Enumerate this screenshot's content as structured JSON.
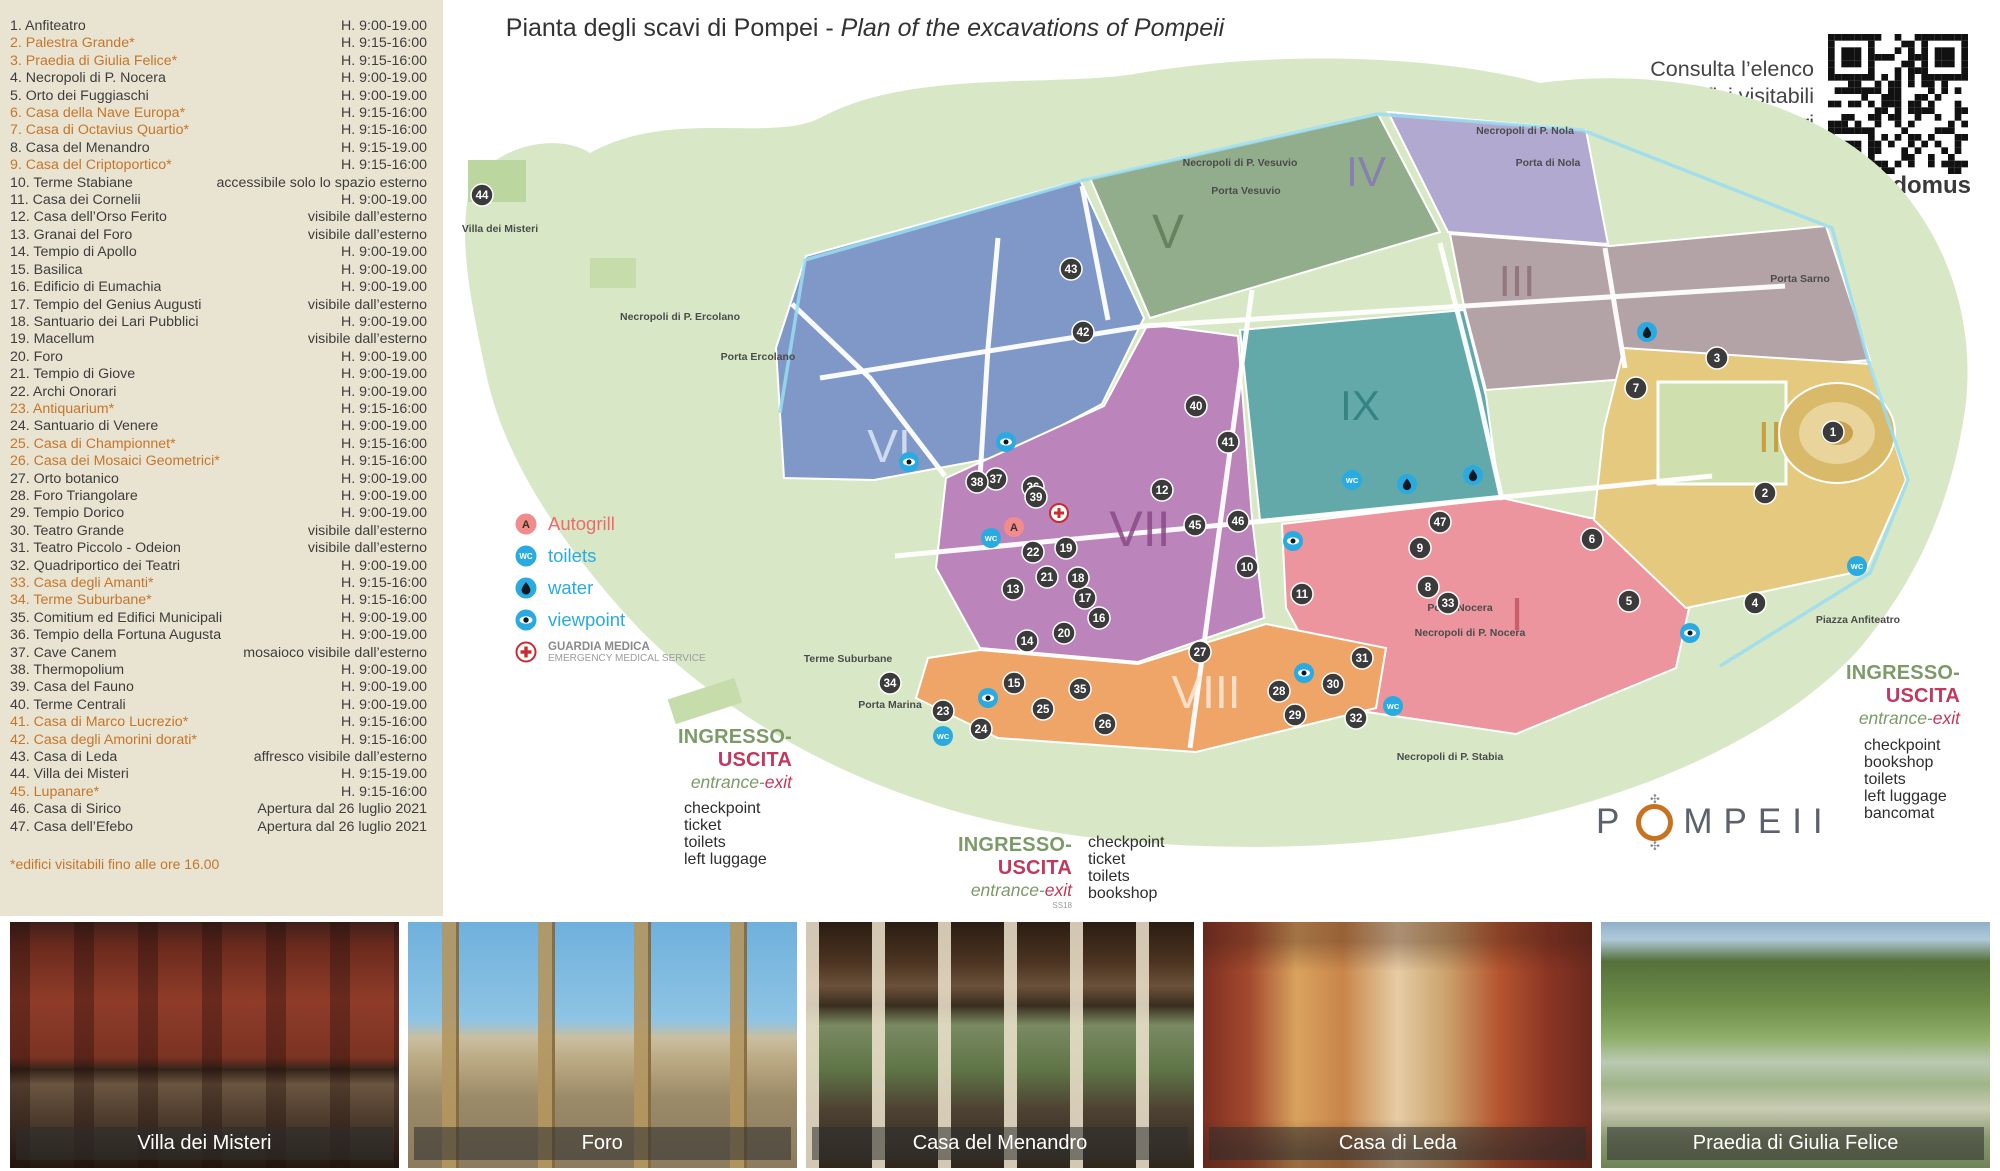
{
  "title": {
    "it": "Pianta degli scavi di Pompei",
    "sep": " - ",
    "en": "Plan of the excavations of Pompeii"
  },
  "info": {
    "lines": [
      "Consulta l’elenco",
      "degli edifici visitabili",
      "aggiornato e gli orari",
      "di apertura"
    ],
    "url": "pompeiisites.org/infodomus",
    "qr": "qr-code"
  },
  "sidebar": {
    "items": [
      {
        "label": "1. Anfiteatro",
        "hours": "H. 9:00-19.00",
        "star": false
      },
      {
        "label": "2. Palestra Grande*",
        "hours": "H. 9:15-16:00",
        "star": true
      },
      {
        "label": "3. Praedia di Giulia Felice*",
        "hours": "H. 9:15-16:00",
        "star": true
      },
      {
        "label": "4. Necropoli di P. Nocera",
        "hours": "H. 9:00-19.00",
        "star": false
      },
      {
        "label": "5. Orto dei Fuggiaschi",
        "hours": "H. 9:00-19.00",
        "star": false
      },
      {
        "label": "6. Casa della Nave Europa*",
        "hours": "H. 9:15-16:00",
        "star": true
      },
      {
        "label": "7. Casa di Octavius Quartio*",
        "hours": "H. 9:15-16:00",
        "star": true
      },
      {
        "label": "8. Casa del Menandro",
        "hours": "H. 9:15-19.00",
        "star": false
      },
      {
        "label": "9. Casa del Criptoportico*",
        "hours": "H. 9:15-16:00",
        "star": true
      },
      {
        "label": "10. Terme Stabiane",
        "hours": "accessibile solo lo spazio esterno",
        "star": false
      },
      {
        "label": "11. Casa dei Cornelii",
        "hours": "H. 9:00-19.00",
        "star": false
      },
      {
        "label": "12. Casa dell’Orso Ferito",
        "hours": "visibile dall’esterno",
        "star": false
      },
      {
        "label": "13. Granai del Foro",
        "hours": "visibile dall’esterno",
        "star": false
      },
      {
        "label": "14. Tempio di Apollo",
        "hours": "H. 9:00-19.00",
        "star": false
      },
      {
        "label": "15. Basilica",
        "hours": "H. 9:00-19.00",
        "star": false
      },
      {
        "label": "16. Edificio di Eumachia",
        "hours": "H. 9:00-19.00",
        "star": false
      },
      {
        "label": "17. Tempio del Genius Augusti",
        "hours": "visibile dall’esterno",
        "star": false
      },
      {
        "label": "18. Santuario dei Lari Pubblici",
        "hours": "H. 9:00-19.00",
        "star": false
      },
      {
        "label": "19. Macellum",
        "hours": "visibile dall’esterno",
        "star": false
      },
      {
        "label": "20. Foro",
        "hours": "H. 9:00-19.00",
        "star": false
      },
      {
        "label": "21. Tempio di Giove",
        "hours": "H. 9:00-19.00",
        "star": false
      },
      {
        "label": "22. Archi Onorari",
        "hours": "H. 9:00-19.00",
        "star": false
      },
      {
        "label": "23. Antiquarium*",
        "hours": "H. 9:15-16:00",
        "star": true
      },
      {
        "label": "24. Santuario di Venere",
        "hours": "H. 9:00-19.00",
        "star": false
      },
      {
        "label": "25. Casa di Championnet*",
        "hours": "H. 9:15-16:00",
        "star": true
      },
      {
        "label": "26. Casa dei Mosaici Geometrici*",
        "hours": "H. 9:15-16:00",
        "star": true
      },
      {
        "label": "27. Orto botanico",
        "hours": "H. 9:00-19.00",
        "star": false
      },
      {
        "label": "28. Foro Triangolare",
        "hours": "H. 9:00-19.00",
        "star": false
      },
      {
        "label": "29. Tempio Dorico",
        "hours": "H. 9:00-19.00",
        "star": false
      },
      {
        "label": "30. Teatro Grande",
        "hours": "visibile dall’esterno",
        "star": false
      },
      {
        "label": "31. Teatro Piccolo - Odeion",
        "hours": "visibile dall’esterno",
        "star": false
      },
      {
        "label": "32. Quadriportico dei Teatri",
        "hours": "H. 9:00-19.00",
        "star": false
      },
      {
        "label": "33. Casa degli Amanti*",
        "hours": "H. 9:15-16:00",
        "star": true
      },
      {
        "label": "34. Terme Suburbane*",
        "hours": "H. 9:15-16:00",
        "star": true
      },
      {
        "label": "35. Comitium ed Edifici Municipali",
        "hours": "H. 9:00-19.00",
        "star": false
      },
      {
        "label": "36. Tempio della Fortuna Augusta",
        "hours": "H. 9:00-19.00",
        "star": false
      },
      {
        "label": "37. Cave Canem",
        "hours": "mosaioco visibile dall’esterno",
        "star": false
      },
      {
        "label": "38. Thermopolium",
        "hours": "H. 9:00-19.00",
        "star": false
      },
      {
        "label": "39. Casa del Fauno",
        "hours": "H. 9:00-19.00",
        "star": false
      },
      {
        "label": "40. Terme Centrali",
        "hours": "H. 9:00-19.00",
        "star": false
      },
      {
        "label": "41. Casa di Marco Lucrezio*",
        "hours": "H. 9:15-16:00",
        "star": true
      },
      {
        "label": "42. Casa degli Amorini dorati*",
        "hours": "H. 9:15-16:00",
        "star": true
      },
      {
        "label": "43. Casa di Leda",
        "hours": "affresco visibile dall’esterno",
        "star": false
      },
      {
        "label": "44. Villa dei Misteri",
        "hours": "H. 9:15-19.00",
        "star": false
      },
      {
        "label": "45. Lupanare*",
        "hours": "H. 9:15-16:00",
        "star": true
      },
      {
        "label": "46. Casa di Sirico",
        "hours": "Apertura dal 26 luglio 2021",
        "star": false
      },
      {
        "label": "47. Casa dell’Efebo",
        "hours": "Apertura dal 26 luglio 2021",
        "star": false
      }
    ],
    "footnote": "*edifici visitabili fino alle ore 16.00"
  },
  "legend": {
    "items": [
      {
        "type": "autogrill",
        "label": "Autogrill"
      },
      {
        "type": "wc",
        "label": "toilets"
      },
      {
        "type": "water",
        "label": "water"
      },
      {
        "type": "viewpoint",
        "label": "viewpoint"
      },
      {
        "type": "medic",
        "label": "GUARDIA MEDICA",
        "sub": "EMERGENCY MEDICAL SERVICE"
      }
    ]
  },
  "entrances": [
    {
      "name": "porta-marina",
      "ingresso": "INGRESSO-",
      "uscita": "USCITA",
      "entrance": "entrance-",
      "exit": "exit",
      "services": [
        "checkpoint",
        "ticket",
        "toilets",
        "left luggage"
      ]
    },
    {
      "name": "piazza-esedra",
      "ingresso": "INGRESSO-",
      "uscita": "USCITA",
      "entrance": "entrance-",
      "exit": "exit",
      "road_label": "SS18",
      "services": [
        "checkpoint",
        "ticket",
        "toilets",
        "bookshop"
      ]
    },
    {
      "name": "piazza-anfiteatro",
      "ingresso": "INGRESSO-",
      "uscita": "USCITA",
      "entrance": "entrance-",
      "exit": "exit",
      "services": [
        "checkpoint",
        "bookshop",
        "toilets",
        "left luggage",
        "bancomat"
      ]
    }
  ],
  "map": {
    "park_color": "#d8e8c6",
    "regions": [
      {
        "numeral": "VI",
        "fill": "#7f98c8",
        "label": "#dde6f6",
        "lx": 449,
        "ly": 414,
        "size": 46
      },
      {
        "numeral": "V",
        "fill": "#92ad8b",
        "label": "#5c7d56",
        "lx": 728,
        "ly": 200,
        "size": 48
      },
      {
        "numeral": "IV",
        "fill": "#b2a9d1",
        "label": "#8678b5",
        "lx": 926,
        "ly": 138,
        "size": 42
      },
      {
        "numeral": "III",
        "fill": "#b4a3a6",
        "label": "#8d7177",
        "lx": 1077,
        "ly": 248,
        "size": 44
      },
      {
        "numeral": "IX",
        "fill": "#63a9a9",
        "label": "#2f7d7d",
        "lx": 920,
        "ly": 372,
        "size": 42
      },
      {
        "numeral": "VII",
        "fill": "#bb84ba",
        "label": "#8a4a88",
        "lx": 700,
        "ly": 498,
        "size": 50
      },
      {
        "numeral": "I",
        "fill": "#ec959e",
        "label": "#c35663",
        "lx": 1077,
        "ly": 582,
        "size": 46
      },
      {
        "numeral": "II",
        "fill": "#e5c97e",
        "label": "#c8962f",
        "lx": 1330,
        "ly": 404,
        "size": 44
      },
      {
        "numeral": "VIII",
        "fill": "#efa468",
        "label": "#fbead8",
        "lx": 766,
        "ly": 660,
        "size": 46
      }
    ],
    "markers": [
      {
        "n": 1,
        "x": 1393,
        "y": 384
      },
      {
        "n": 2,
        "x": 1325,
        "y": 445
      },
      {
        "n": 3,
        "x": 1277,
        "y": 310
      },
      {
        "n": 4,
        "x": 1315,
        "y": 555
      },
      {
        "n": 5,
        "x": 1189,
        "y": 553
      },
      {
        "n": 6,
        "x": 1152,
        "y": 491
      },
      {
        "n": 7,
        "x": 1196,
        "y": 340
      },
      {
        "n": 8,
        "x": 988,
        "y": 539
      },
      {
        "n": 9,
        "x": 980,
        "y": 500
      },
      {
        "n": 10,
        "x": 807,
        "y": 519
      },
      {
        "n": 11,
        "x": 862,
        "y": 546
      },
      {
        "n": 12,
        "x": 722,
        "y": 442
      },
      {
        "n": 13,
        "x": 573,
        "y": 541
      },
      {
        "n": 14,
        "x": 587,
        "y": 593
      },
      {
        "n": 15,
        "x": 574,
        "y": 635
      },
      {
        "n": 16,
        "x": 659,
        "y": 570
      },
      {
        "n": 17,
        "x": 645,
        "y": 550
      },
      {
        "n": 18,
        "x": 638,
        "y": 530
      },
      {
        "n": 19,
        "x": 626,
        "y": 500
      },
      {
        "n": 20,
        "x": 624,
        "y": 585
      },
      {
        "n": 21,
        "x": 607,
        "y": 529
      },
      {
        "n": 22,
        "x": 593,
        "y": 504
      },
      {
        "n": 23,
        "x": 503,
        "y": 663
      },
      {
        "n": 24,
        "x": 541,
        "y": 681
      },
      {
        "n": 25,
        "x": 603,
        "y": 661
      },
      {
        "n": 26,
        "x": 665,
        "y": 676
      },
      {
        "n": 27,
        "x": 760,
        "y": 604
      },
      {
        "n": 28,
        "x": 839,
        "y": 643
      },
      {
        "n": 29,
        "x": 855,
        "y": 667
      },
      {
        "n": 30,
        "x": 893,
        "y": 636
      },
      {
        "n": 31,
        "x": 922,
        "y": 610
      },
      {
        "n": 32,
        "x": 916,
        "y": 670
      },
      {
        "n": 33,
        "x": 1008,
        "y": 555
      },
      {
        "n": 34,
        "x": 450,
        "y": 635
      },
      {
        "n": 35,
        "x": 640,
        "y": 641
      },
      {
        "n": 36,
        "x": 593,
        "y": 439
      },
      {
        "n": 37,
        "x": 556,
        "y": 431
      },
      {
        "n": 38,
        "x": 537,
        "y": 434
      },
      {
        "n": 39,
        "x": 596,
        "y": 449
      },
      {
        "n": 40,
        "x": 756,
        "y": 358
      },
      {
        "n": 41,
        "x": 788,
        "y": 394
      },
      {
        "n": 42,
        "x": 643,
        "y": 284
      },
      {
        "n": 43,
        "x": 631,
        "y": 221
      },
      {
        "n": 44,
        "x": 42,
        "y": 147
      },
      {
        "n": 45,
        "x": 755,
        "y": 477
      },
      {
        "n": 46,
        "x": 798,
        "y": 473
      },
      {
        "n": 47,
        "x": 1000,
        "y": 474
      }
    ],
    "icons": [
      {
        "t": "wc",
        "x": 551,
        "y": 490
      },
      {
        "t": "wc",
        "x": 912,
        "y": 432
      },
      {
        "t": "wc",
        "x": 953,
        "y": 658
      },
      {
        "t": "wc",
        "x": 1417,
        "y": 518
      },
      {
        "t": "wc",
        "x": 503,
        "y": 688
      },
      {
        "t": "water",
        "x": 1207,
        "y": 284
      },
      {
        "t": "water",
        "x": 967,
        "y": 436
      },
      {
        "t": "water",
        "x": 1033,
        "y": 427
      },
      {
        "t": "viewpoint",
        "x": 469,
        "y": 414
      },
      {
        "t": "viewpoint",
        "x": 566,
        "y": 394
      },
      {
        "t": "viewpoint",
        "x": 853,
        "y": 493
      },
      {
        "t": "viewpoint",
        "x": 864,
        "y": 625
      },
      {
        "t": "viewpoint",
        "x": 548,
        "y": 650
      },
      {
        "t": "viewpoint",
        "x": 1250,
        "y": 585
      },
      {
        "t": "autogrill",
        "x": 574,
        "y": 479
      },
      {
        "t": "medic",
        "x": 619,
        "y": 465
      }
    ],
    "labels": [
      {
        "t": "Villa dei Misteri",
        "x": 60,
        "y": 184
      },
      {
        "t": "Necropoli di P. Ercolano",
        "x": 240,
        "y": 272
      },
      {
        "t": "Porta Ercolano",
        "x": 318,
        "y": 312
      },
      {
        "t": "Necropoli di P. Vesuvio",
        "x": 800,
        "y": 118
      },
      {
        "t": "Porta Vesuvio",
        "x": 806,
        "y": 146
      },
      {
        "t": "Necropoli di P. Nola",
        "x": 1085,
        "y": 86
      },
      {
        "t": "Porta di Nola",
        "x": 1108,
        "y": 118
      },
      {
        "t": "Porta Sarno",
        "x": 1360,
        "y": 234
      },
      {
        "t": "Terme Suburbane",
        "x": 408,
        "y": 614
      },
      {
        "t": "Porta Marina",
        "x": 450,
        "y": 660
      },
      {
        "t": "Porta Nocera",
        "x": 1020,
        "y": 563
      },
      {
        "t": "Necropoli di P. Nocera",
        "x": 1030,
        "y": 588
      },
      {
        "t": "Necropoli di P. Stabia",
        "x": 1010,
        "y": 712
      },
      {
        "t": "Piazza Anfiteatro",
        "x": 1418,
        "y": 575
      }
    ]
  },
  "logo": {
    "pre": "P",
    "post": "MPEII"
  },
  "photos": [
    {
      "caption": "Villa dei Misteri"
    },
    {
      "caption": "Foro"
    },
    {
      "caption": "Casa del Menandro"
    },
    {
      "caption": "Casa di Leda"
    },
    {
      "caption": "Praedia di Giulia Felice"
    }
  ]
}
